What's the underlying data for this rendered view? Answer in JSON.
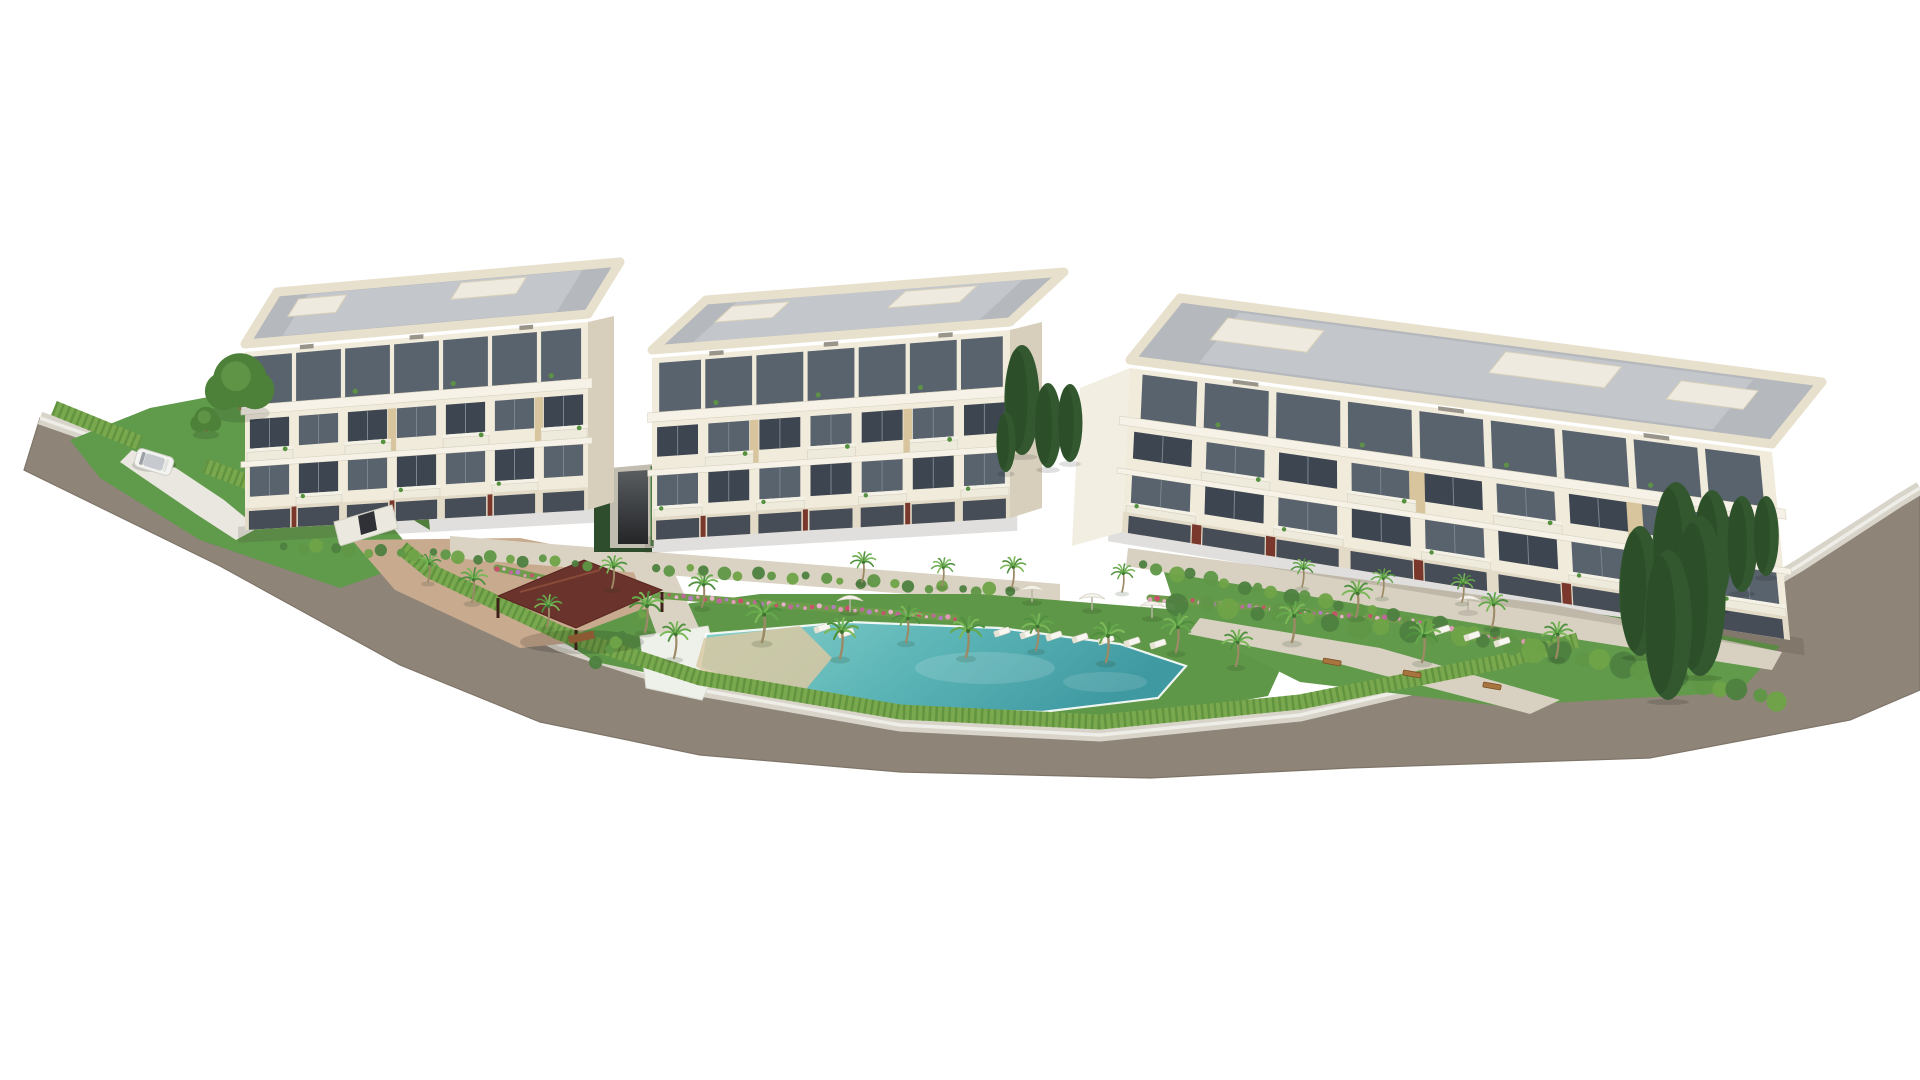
{
  "meta": {
    "alt": "Aerial 3D architectural rendering of a residential complex: three cream apartment buildings, communal gardens, palm trees, swimming pool with sand beach entry, gazebo, and a road wrapping the plot",
    "background": "#ffffff",
    "width": 1920,
    "height": 1080
  },
  "palette": {
    "wall": "#f1ebdc",
    "wallShade": "#e3dbc7",
    "slab": "#f6f2e7",
    "parapet": "#e7e0cc",
    "roofDeck": "#b5b8bc",
    "roofLight": "#c9ccd0",
    "roofBox": "#efeadf",
    "glassDark": "#3d4650",
    "glassMid": "#59636d",
    "glassLight": "#7b858f",
    "maroon": "#7a382d",
    "awning": "#d6c39a",
    "roadFill": "#8e8478",
    "roadEdge": "#7e7468",
    "sidewalk": "#d8d4ca",
    "kerb": "#eeede7",
    "hedge": "#79a84e",
    "hedgeDark": "#5b8c3b",
    "lawn": "#5f9748",
    "lawnDark": "#548a40",
    "pathBeige": "#dad3c3",
    "terraceTan": "#c8aa8f",
    "poolDeep": "#3f99a1",
    "poolLight": "#86d0cb",
    "poolSand": "#d8c8a2",
    "poolEdge": "#eef0ea",
    "gazeboRoof": "#6a332b",
    "gazeboRidge": "#8a4a3a",
    "gazeboPost": "#3c2117",
    "trunk": "#9c8a66",
    "cypress": "#33582f",
    "cypressDark": "#2a4a27",
    "canopy": "#f5f3ec",
    "benchWood": "#a8743f",
    "flowerColors": [
      "#c2679b",
      "#b07ec0",
      "#e09ab8",
      "#c94f6d",
      "#e6b3cc"
    ],
    "palmGreens": [
      "#4f903e",
      "#65a84c",
      "#7ab858"
    ]
  },
  "road": {
    "inner": [
      [
        40,
        418
      ],
      [
        240,
        488
      ],
      [
        430,
        583
      ],
      [
        560,
        645
      ],
      [
        700,
        690
      ],
      [
        900,
        725
      ],
      [
        1100,
        735
      ],
      [
        1300,
        715
      ],
      [
        1500,
        668
      ],
      [
        1680,
        636
      ],
      [
        1800,
        565
      ],
      [
        1900,
        500
      ],
      [
        1920,
        488
      ]
    ],
    "outer": [
      [
        24,
        470
      ],
      [
        220,
        566
      ],
      [
        400,
        665
      ],
      [
        540,
        722
      ],
      [
        700,
        755
      ],
      [
        900,
        772
      ],
      [
        1150,
        778
      ],
      [
        1350,
        768
      ],
      [
        1650,
        758
      ],
      [
        1850,
        720
      ],
      [
        1920,
        690
      ]
    ]
  },
  "hedgeSegments": [
    [
      [
        54,
        408
      ],
      [
        140,
        443
      ]
    ],
    [
      [
        205,
        466
      ],
      [
        336,
        515
      ]
    ],
    [
      [
        402,
        548
      ],
      [
        430,
        571
      ],
      [
        560,
        633
      ],
      [
        700,
        678
      ],
      [
        900,
        712
      ],
      [
        1100,
        722
      ],
      [
        1300,
        702
      ],
      [
        1500,
        662
      ],
      [
        1578,
        640
      ]
    ]
  ],
  "ground": [
    {
      "name": "left-lawn",
      "fill": "#609a4b",
      "pts": [
        [
          70,
          440
        ],
        [
          150,
          408
        ],
        [
          235,
          392
        ],
        [
          330,
          452
        ],
        [
          420,
          560
        ],
        [
          340,
          588
        ],
        [
          200,
          540
        ],
        [
          100,
          478
        ]
      ]
    },
    {
      "name": "left-back-lawn",
      "fill": "#568c41",
      "pts": [
        [
          230,
          388
        ],
        [
          300,
          370
        ],
        [
          420,
          430
        ],
        [
          430,
          530
        ],
        [
          330,
          470
        ]
      ]
    },
    {
      "name": "driveway",
      "fill": "#e9e7df",
      "pts": [
        [
          132,
          450
        ],
        [
          176,
          468
        ],
        [
          224,
          500
        ],
        [
          258,
          528
        ],
        [
          236,
          540
        ],
        [
          196,
          514
        ],
        [
          152,
          484
        ],
        [
          120,
          462
        ]
      ]
    },
    {
      "name": "terrace-tan",
      "fill": "#c8aa8f",
      "pts": [
        [
          352,
          540
        ],
        [
          520,
          538
        ],
        [
          640,
          562
        ],
        [
          662,
          634
        ],
        [
          520,
          648
        ],
        [
          395,
          590
        ]
      ]
    },
    {
      "name": "central-path",
      "fill": "#dad3c3",
      "pts": [
        [
          450,
          536
        ],
        [
          1060,
          584
        ],
        [
          1060,
          606
        ],
        [
          450,
          558
        ]
      ]
    },
    {
      "name": "pool-lawn",
      "fill": "#5f9748",
      "pts": [
        [
          560,
          640
        ],
        [
          640,
          610
        ],
        [
          760,
          594
        ],
        [
          980,
          594
        ],
        [
          1180,
          610
        ],
        [
          1290,
          648
        ],
        [
          1268,
          696
        ],
        [
          1100,
          726
        ],
        [
          900,
          716
        ],
        [
          700,
          684
        ],
        [
          596,
          662
        ]
      ]
    },
    {
      "name": "right-garden-lawn",
      "fill": "#619a4a",
      "pts": [
        [
          1160,
          560
        ],
        [
          1400,
          586
        ],
        [
          1640,
          620
        ],
        [
          1780,
          646
        ],
        [
          1740,
          692
        ],
        [
          1500,
          706
        ],
        [
          1300,
          682
        ],
        [
          1180,
          622
        ]
      ]
    },
    {
      "name": "path-vertical",
      "fill": "#dad3c3",
      "pts": [
        [
          628,
          556
        ],
        [
          666,
          554
        ],
        [
          700,
          630
        ],
        [
          658,
          638
        ]
      ]
    },
    {
      "name": "path-b3-front",
      "fill": "#d8d1c1",
      "pts": [
        [
          1128,
          548
        ],
        [
          1560,
          606
        ],
        [
          1782,
          652
        ],
        [
          1772,
          670
        ],
        [
          1480,
          624
        ],
        [
          1126,
          566
        ]
      ]
    },
    {
      "name": "path-right-diag",
      "fill": "#d8d1c1",
      "pts": [
        [
          1200,
          618
        ],
        [
          1380,
          648
        ],
        [
          1560,
          700
        ],
        [
          1530,
          714
        ],
        [
          1340,
          664
        ],
        [
          1188,
          634
        ]
      ]
    }
  ],
  "pool": {
    "deck": [
      [
        640,
        636
      ],
      [
        708,
        626
      ],
      [
        718,
        666
      ],
      [
        702,
        700
      ],
      [
        646,
        688
      ]
    ],
    "water": [
      [
        706,
        634
      ],
      [
        850,
        622
      ],
      [
        1000,
        628
      ],
      [
        1120,
        644
      ],
      [
        1186,
        666
      ],
      [
        1158,
        698
      ],
      [
        1042,
        712
      ],
      [
        900,
        708
      ],
      [
        788,
        698
      ],
      [
        700,
        668
      ]
    ],
    "sandPoly": [
      [
        704,
        638
      ],
      [
        800,
        626
      ],
      [
        832,
        658
      ],
      [
        802,
        694
      ],
      [
        722,
        688
      ],
      [
        696,
        666
      ]
    ]
  },
  "gazebo": {
    "roof": [
      [
        498,
        596
      ],
      [
        584,
        560
      ],
      [
        662,
        590
      ],
      [
        576,
        628
      ]
    ],
    "ridge": [
      [
        520,
        592
      ],
      [
        600,
        570
      ]
    ],
    "postDrop": 20,
    "table": {
      "x": 568,
      "y": 636,
      "w": 26,
      "h": 8
    }
  },
  "gate": {
    "body": [
      [
        334,
        522
      ],
      [
        392,
        505
      ],
      [
        398,
        528
      ],
      [
        340,
        546
      ]
    ],
    "door": [
      [
        358,
        516
      ],
      [
        374,
        511
      ],
      [
        377,
        530
      ],
      [
        361,
        535
      ]
    ]
  },
  "ramp": {
    "backdrop": [
      [
        594,
        470
      ],
      [
        652,
        466
      ],
      [
        652,
        552
      ],
      [
        594,
        552
      ]
    ],
    "outer": [
      [
        610,
        468
      ],
      [
        654,
        464
      ],
      [
        654,
        548
      ],
      [
        610,
        548
      ]
    ],
    "inner": [
      [
        618,
        472
      ],
      [
        648,
        470
      ],
      [
        648,
        544
      ],
      [
        618,
        544
      ]
    ],
    "fence": [
      [
        652,
        466
      ],
      [
        652,
        546
      ]
    ]
  },
  "buildings": [
    {
      "name": "building-left",
      "facade": [
        [
          245,
          352
        ],
        [
          588,
          322
        ],
        [
          588,
          510
        ],
        [
          245,
          530
        ]
      ],
      "side": {
        "pts": [
          [
            588,
            322
          ],
          [
            614,
            316
          ],
          [
            614,
            502
          ],
          [
            588,
            510
          ]
        ],
        "fill": "#d7cfbc"
      },
      "roof": {
        "pts": [
          [
            245,
            344
          ],
          [
            588,
            314
          ],
          [
            620,
            262
          ],
          [
            277,
            292
          ]
        ],
        "boxes": [
          {
            "u0": 0.08,
            "v0": 0.18,
            "u1": 0.22,
            "v1": 0.52
          },
          {
            "u0": 0.55,
            "v0": 0.14,
            "u1": 0.74,
            "v1": 0.46
          }
        ]
      },
      "bays": 7,
      "balc2": [
        0,
        2,
        4,
        6
      ],
      "balc3": [
        1,
        3,
        5
      ],
      "maroon": [
        1,
        3,
        5
      ],
      "wood": [
        2,
        5
      ]
    },
    {
      "name": "building-middle",
      "facade": [
        [
          652,
          358
        ],
        [
          1010,
          330
        ],
        [
          1010,
          518
        ],
        [
          652,
          540
        ]
      ],
      "side": {
        "pts": [
          [
            1010,
            330
          ],
          [
            1042,
            322
          ],
          [
            1042,
            508
          ],
          [
            1010,
            518
          ]
        ],
        "fill": "#d7cfbc"
      },
      "roof": {
        "pts": [
          [
            652,
            350
          ],
          [
            1010,
            322
          ],
          [
            1064,
            272
          ],
          [
            706,
            300
          ]
        ],
        "boxes": [
          {
            "u0": 0.1,
            "v0": 0.18,
            "u1": 0.26,
            "v1": 0.5
          },
          {
            "u0": 0.58,
            "v0": 0.15,
            "u1": 0.78,
            "v1": 0.48
          }
        ]
      },
      "bays": 7,
      "balc2": [
        1,
        3,
        5
      ],
      "balc3": [
        0,
        2,
        4,
        6
      ],
      "maroon": [
        1,
        3,
        5
      ],
      "wood": [
        1,
        4
      ]
    },
    {
      "name": "building-right",
      "facade": [
        [
          1130,
          368
        ],
        [
          1772,
          452
        ],
        [
          1790,
          640
        ],
        [
          1122,
          532
        ]
      ],
      "side": {
        "pts": [
          [
            1080,
            388
          ],
          [
            1130,
            368
          ],
          [
            1122,
            532
          ],
          [
            1072,
            546
          ]
        ],
        "fill": "#f2eee2"
      },
      "roof": {
        "pts": [
          [
            1130,
            360
          ],
          [
            1772,
            444
          ],
          [
            1822,
            382
          ],
          [
            1180,
            298
          ]
        ],
        "boxes": [
          {
            "u0": 0.09,
            "v0": 0.2,
            "u1": 0.24,
            "v1": 0.55
          },
          {
            "u0": 0.52,
            "v0": 0.16,
            "u1": 0.7,
            "v1": 0.5
          },
          {
            "u0": 0.8,
            "v0": 0.25,
            "u1": 0.92,
            "v1": 0.55
          }
        ]
      },
      "bays": 9,
      "balc2": [
        1,
        3,
        5,
        7
      ],
      "balc3": [
        0,
        2,
        4,
        6,
        8
      ],
      "maroon": [
        1,
        2,
        4,
        6,
        7
      ],
      "wood": [
        3,
        6
      ]
    }
  ],
  "vegetation": {
    "palms": [
      [
        645,
        632,
        1.0
      ],
      [
        612,
        588,
        0.8
      ],
      [
        674,
        658,
        0.9
      ],
      [
        702,
        607,
        0.85
      ],
      [
        762,
        642,
        1.05
      ],
      [
        840,
        658,
        1.0
      ],
      [
        906,
        642,
        0.9
      ],
      [
        966,
        657,
        1.0
      ],
      [
        1036,
        650,
        0.9
      ],
      [
        1106,
        662,
        1.0
      ],
      [
        1176,
        652,
        0.95
      ],
      [
        1236,
        666,
        0.9
      ],
      [
        862,
        582,
        0.75
      ],
      [
        942,
        586,
        0.7
      ],
      [
        1012,
        587,
        0.75
      ],
      [
        1122,
        592,
        0.7
      ],
      [
        1292,
        642,
        1.0
      ],
      [
        1356,
        617,
        0.9
      ],
      [
        1422,
        662,
        1.0
      ],
      [
        1492,
        627,
        0.85
      ],
      [
        1556,
        658,
        0.9
      ],
      [
        472,
        602,
        0.85
      ],
      [
        428,
        582,
        0.7
      ],
      [
        547,
        627,
        0.8
      ],
      [
        1302,
        587,
        0.7
      ],
      [
        1382,
        597,
        0.7
      ],
      [
        1462,
        602,
        0.7
      ]
    ],
    "cypressGap": [
      [
        1022,
        455,
        110
      ],
      [
        1048,
        468,
        85
      ],
      [
        1006,
        472,
        60
      ],
      [
        1070,
        462,
        78
      ]
    ],
    "cypressRight": [
      [
        1640,
        656,
        130
      ],
      [
        1676,
        632,
        150
      ],
      [
        1712,
        610,
        120
      ],
      [
        1742,
        592,
        96
      ],
      [
        1700,
        676,
        160
      ],
      [
        1668,
        700,
        150
      ],
      [
        1766,
        576,
        80
      ]
    ],
    "roundTrees": [
      [
        240,
        410,
        27
      ],
      [
        206,
        432,
        12
      ]
    ],
    "bushRows": [
      {
        "a": [
          285,
          546
        ],
        "b": [
          590,
          564
        ],
        "n": 20,
        "r": 5,
        "seed": 3
      },
      {
        "a": [
          655,
          568
        ],
        "b": [
          1010,
          592
        ],
        "n": 22,
        "r": 5,
        "seed": 11
      },
      {
        "a": [
          1140,
          566
        ],
        "b": [
          1560,
          648
        ],
        "n": 26,
        "r": 6,
        "seed": 17
      },
      {
        "a": [
          1180,
          602
        ],
        "b": [
          1560,
          652
        ],
        "n": 16,
        "r": 9,
        "seed": 23
      },
      {
        "a": [
          1560,
          652
        ],
        "b": [
          1780,
          700
        ],
        "n": 12,
        "r": 10,
        "seed": 29
      },
      {
        "a": [
          596,
          660
        ],
        "b": [
          646,
          616
        ],
        "n": 6,
        "r": 5,
        "seed": 31
      }
    ],
    "flowerBeds": [
      {
        "a": [
          545,
          583
        ],
        "b": [
          625,
          598
        ]
      },
      {
        "a": [
          655,
          595
        ],
        "b": [
          955,
          618
        ]
      },
      {
        "a": [
          1150,
          598
        ],
        "b": [
          1420,
          622
        ]
      },
      {
        "a": [
          497,
          568
        ],
        "b": [
          560,
          582
        ]
      },
      {
        "a": [
          1430,
          626
        ],
        "b": [
          1560,
          648
        ]
      }
    ]
  },
  "furniture": {
    "umbrellas": [
      {
        "x": 850,
        "y": 612,
        "loungers": [
          [
            822,
            628
          ],
          [
            846,
            633
          ]
        ]
      },
      {
        "x": 1032,
        "y": 602,
        "loungers": []
      },
      {
        "x": 1092,
        "y": 610,
        "loungers": []
      },
      {
        "x": 1152,
        "y": 618,
        "loungers": []
      },
      {
        "x": 1468,
        "y": 612,
        "loungers": [
          [
            1442,
            630
          ],
          [
            1472,
            636
          ],
          [
            1502,
            642
          ]
        ]
      }
    ],
    "loungerRow": {
      "x0": 1002,
      "y0": 632,
      "dx": 26,
      "dy": 2,
      "n": 7
    },
    "benches": [
      [
        1332,
        662
      ],
      [
        1412,
        674
      ],
      [
        1492,
        686
      ]
    ]
  },
  "car": {
    "x": 154,
    "y": 462,
    "angle": 17
  }
}
